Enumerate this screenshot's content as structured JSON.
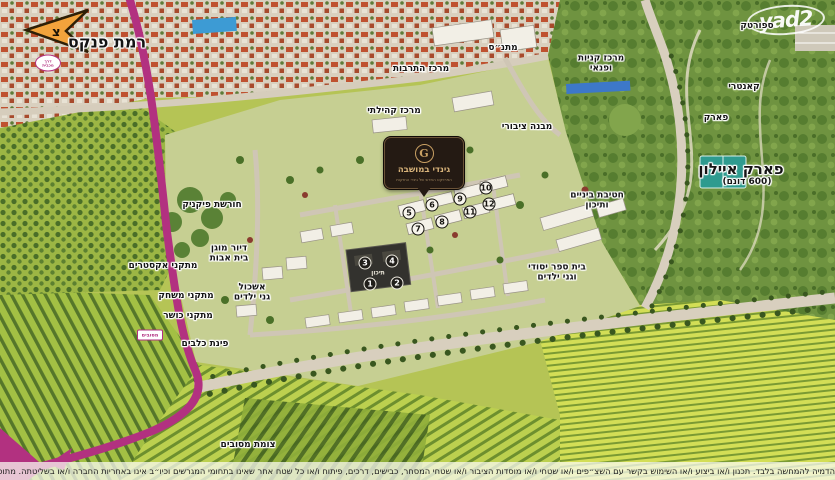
{
  "watermark": {
    "text": "yad2"
  },
  "compass": {
    "letter": "צ"
  },
  "logo": {
    "monogram": "G",
    "brand": "גינדי במושבה",
    "tagline": "הפרויקט החדש של גינדי החזקות"
  },
  "labels": [
    {
      "name": "ramat-pinkas",
      "text": "רמת פנקס",
      "x": 107,
      "y": 42,
      "size": 16
    },
    {
      "name": "sportek",
      "text": "ספורטק",
      "x": 757,
      "y": 27,
      "size": 9
    },
    {
      "name": "matnas",
      "text": "מתנ״ס",
      "x": 503,
      "y": 49,
      "size": 9
    },
    {
      "name": "culture-center",
      "text": "מרכז התרבות",
      "x": 421,
      "y": 70,
      "size": 9
    },
    {
      "name": "shopping-leisure-center",
      "text": "מרכז קניות\nופנאי",
      "x": 601,
      "y": 64,
      "size": 9
    },
    {
      "name": "country-club",
      "text": "קאנטרי",
      "x": 744,
      "y": 88,
      "size": 9
    },
    {
      "name": "park",
      "text": "פארק",
      "x": 716,
      "y": 119,
      "size": 9
    },
    {
      "name": "community-center",
      "text": "מרכז קהילתי",
      "x": 394,
      "y": 112,
      "size": 9
    },
    {
      "name": "public-building",
      "text": "מבנה ציבורי",
      "x": 527,
      "y": 128,
      "size": 9
    },
    {
      "name": "park-ayalon",
      "text": "פארק איילון",
      "x": 741,
      "y": 169,
      "size": 15
    },
    {
      "name": "park-ayalon-size",
      "text": "(600 דונם)",
      "x": 747,
      "y": 183,
      "size": 9
    },
    {
      "name": "junior-high-school",
      "text": "חטיבת ביניים\nותיכון",
      "x": 597,
      "y": 201,
      "size": 9
    },
    {
      "name": "elementary-school",
      "text": "בית ספר יסודי\nוגני ילדים",
      "x": 557,
      "y": 273,
      "size": 9
    },
    {
      "name": "picnic-grove",
      "text": "חורשת פיקניק",
      "x": 212,
      "y": 206,
      "size": 9
    },
    {
      "name": "assisted-living",
      "text": "דיור מוגן\nבית אבות",
      "x": 229,
      "y": 254,
      "size": 9
    },
    {
      "name": "extreme-facilities",
      "text": "מתקני אקסטרים",
      "x": 163,
      "y": 267,
      "size": 9
    },
    {
      "name": "playground-facilities",
      "text": "מתקני משחק",
      "x": 186,
      "y": 297,
      "size": 9
    },
    {
      "name": "kindergarten-cluster",
      "text": "אשכול\nגני ילדים",
      "x": 252,
      "y": 293,
      "size": 9
    },
    {
      "name": "fitness-facilities",
      "text": "מתקני כושר",
      "x": 188,
      "y": 317,
      "size": 9
    },
    {
      "name": "dog-park",
      "text": "פינת כלבים",
      "x": 205,
      "y": 345,
      "size": 9
    },
    {
      "name": "mesubim-junction",
      "text": "צומת מסובים",
      "x": 248,
      "y": 446,
      "size": 9
    }
  ],
  "road_badges": [
    {
      "name": "road-badge-north",
      "text": "דרך\nמכבית",
      "x": 48,
      "y": 63,
      "shape": "oval"
    },
    {
      "name": "road-badge-south",
      "text": "מסובים",
      "x": 150,
      "y": 335,
      "shape": "rect"
    }
  ],
  "building_markers": {
    "light": [
      {
        "n": "5",
        "x": 409,
        "y": 213
      },
      {
        "n": "6",
        "x": 432,
        "y": 205
      },
      {
        "n": "7",
        "x": 418,
        "y": 229
      },
      {
        "n": "8",
        "x": 442,
        "y": 222
      },
      {
        "n": "9",
        "x": 460,
        "y": 199
      },
      {
        "n": "10",
        "x": 486,
        "y": 188
      },
      {
        "n": "11",
        "x": 470,
        "y": 212
      },
      {
        "n": "12",
        "x": 489,
        "y": 204
      }
    ],
    "dark": [
      {
        "n": "3",
        "x": 365,
        "y": 263
      },
      {
        "n": "4",
        "x": 392,
        "y": 261
      },
      {
        "n": "1",
        "x": 370,
        "y": 284
      },
      {
        "n": "2",
        "x": 397,
        "y": 283
      }
    ],
    "center_roof_label": "תיכון"
  },
  "disclaimer": "הדמיה להמחשה בלבד. תכנון ו/או ביצוע ו/או השימוש בקשר עם השצ״פים ו/או שטחי ו/או מוסדות הציבור ו/או שטחי המסחר, כבישים, דרכים, פיתוח ו/או כל שטח אחר שאינו בתחומי המגרשים וכיו״ב אינו באחריות החברה ו/או בשליטתה. מתוכננים בניינים נוספים לפי התב״ע.",
  "colors": {
    "highlight_road": "#b23180",
    "field_light": "#c3d253",
    "field_dark": "#5d7f2a",
    "park_green": "#6f9340",
    "roofs_orange": "#bf5130",
    "logo_bg": "#241a13",
    "logo_gold": "#d8b37a"
  }
}
